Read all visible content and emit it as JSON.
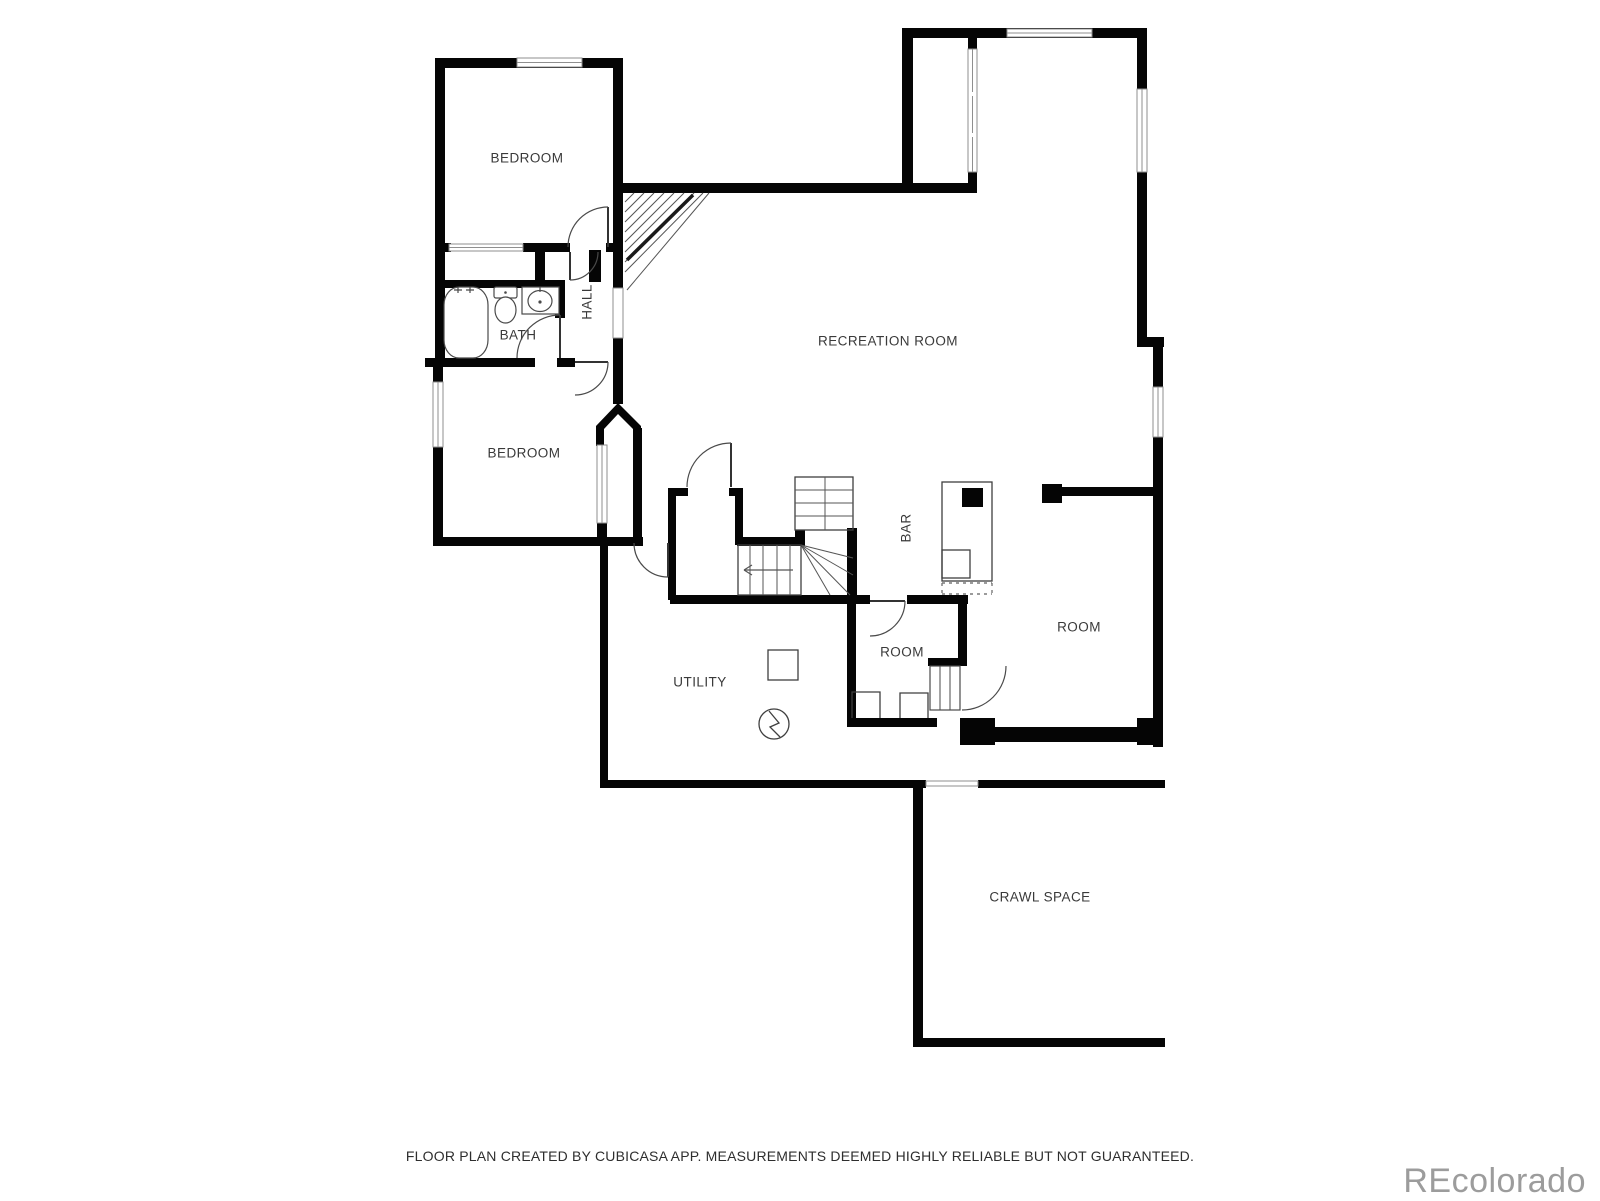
{
  "labels": {
    "bedroom_upper": "BEDROOM",
    "bath": "BATH",
    "hall": "HALL",
    "recreation_room": "RECREATION ROOM",
    "bedroom_lower": "BEDROOM",
    "bar": "BAR",
    "room_small": "ROOM",
    "room_right": "ROOM",
    "utility": "UTILITY",
    "crawl_space": "CRAWL SPACE"
  },
  "footer": {
    "disclaimer": "FLOOR PLAN CREATED BY CUBICASA APP. MEASUREMENTS DEEMED HIGHLY RELIABLE BUT NOT GUARANTEED."
  },
  "watermark": {
    "text": "REcolorado",
    "color": "#9c9c9c"
  },
  "colors": {
    "wall": "#050505",
    "thin_line": "#3f3f3f",
    "label_text": "#3a3a3a",
    "background": "#ffffff"
  }
}
